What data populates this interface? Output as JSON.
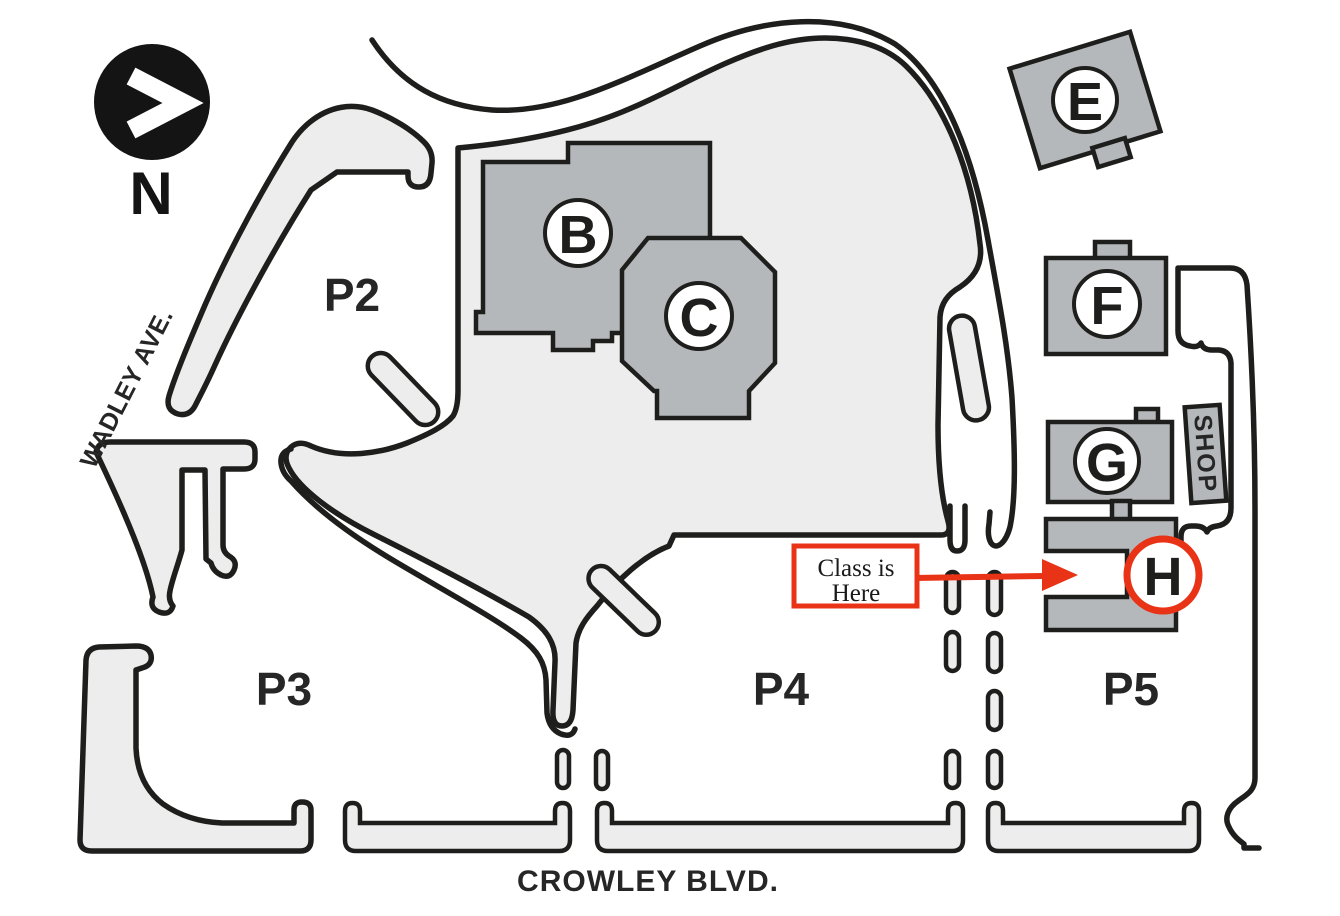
{
  "colors": {
    "accent_red": "#e93317",
    "building_gray": "#b5b8bb",
    "road_gray": "#ededed",
    "line_black": "#1e1e1c",
    "label_color": "#262626"
  },
  "compass": {
    "label": "N"
  },
  "streets": {
    "wadley": "WADLEY AVE.",
    "crowley": "CROWLEY BLVD."
  },
  "parking": {
    "p2": "P2",
    "p3": "P3",
    "p4": "P4",
    "p5": "P5"
  },
  "buildings": {
    "b": "B",
    "c": "C",
    "e": "E",
    "f": "F",
    "g": "G",
    "h": "H"
  },
  "shop": {
    "label": "SHOP"
  },
  "callout": {
    "line1": "Class is",
    "line2": "Here"
  }
}
